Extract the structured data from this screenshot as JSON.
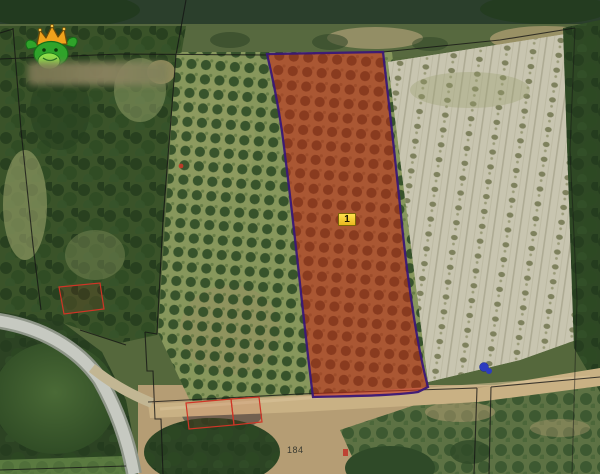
{
  "map": {
    "marker": {
      "label": "1",
      "background": "#f2c72e",
      "border": "#7a6607"
    },
    "parcel_label": {
      "text": "184"
    },
    "selected_parcel": {
      "fill": "#c52a16",
      "fill_opacity": 0.58,
      "stroke": "#3a1877"
    },
    "logo": {
      "icon": "crowned-frog-logo",
      "crown_color": "#f0a21c",
      "body_color": "#2fa32a"
    },
    "watermark": {
      "blurred": true
    },
    "annotations": {
      "red_outline_color": "#cf3526",
      "blue_marker_color": "#2d3bbf",
      "boundary_line_color": "#141414"
    }
  }
}
